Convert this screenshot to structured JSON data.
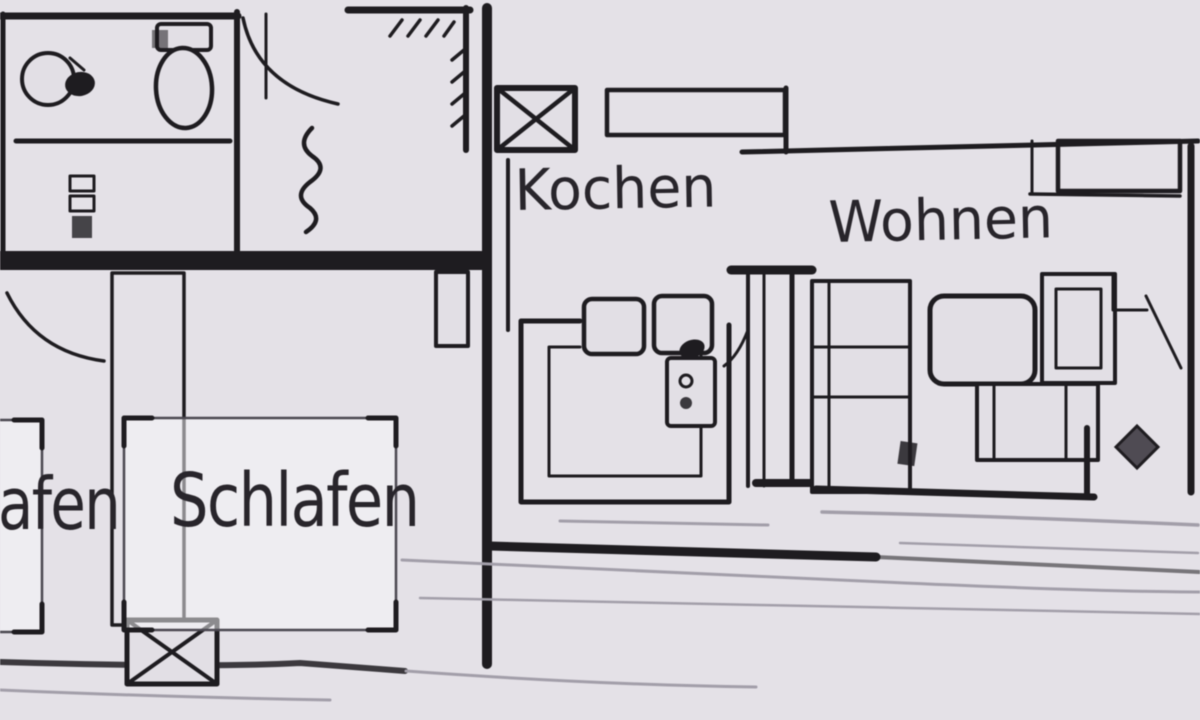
{
  "colors": {
    "paper": "#e4e1e7",
    "ink": "#1c1a1e",
    "faint": "#a39faa",
    "text": "#262329"
  },
  "rooms": {
    "kitchen": {
      "label": "Kochen"
    },
    "living": {
      "label": "Wohnen"
    },
    "bedroom": {
      "label": "Schlafen"
    },
    "bedroom_left": {
      "label": "afen"
    }
  },
  "icons": {
    "window_symbol": "diagonal-hatch-window",
    "shaft_symbol": "crossed-box-shaft",
    "chimney_symbol": "crosshatched-flue-column",
    "plant_symbol": "filled-diamond"
  }
}
